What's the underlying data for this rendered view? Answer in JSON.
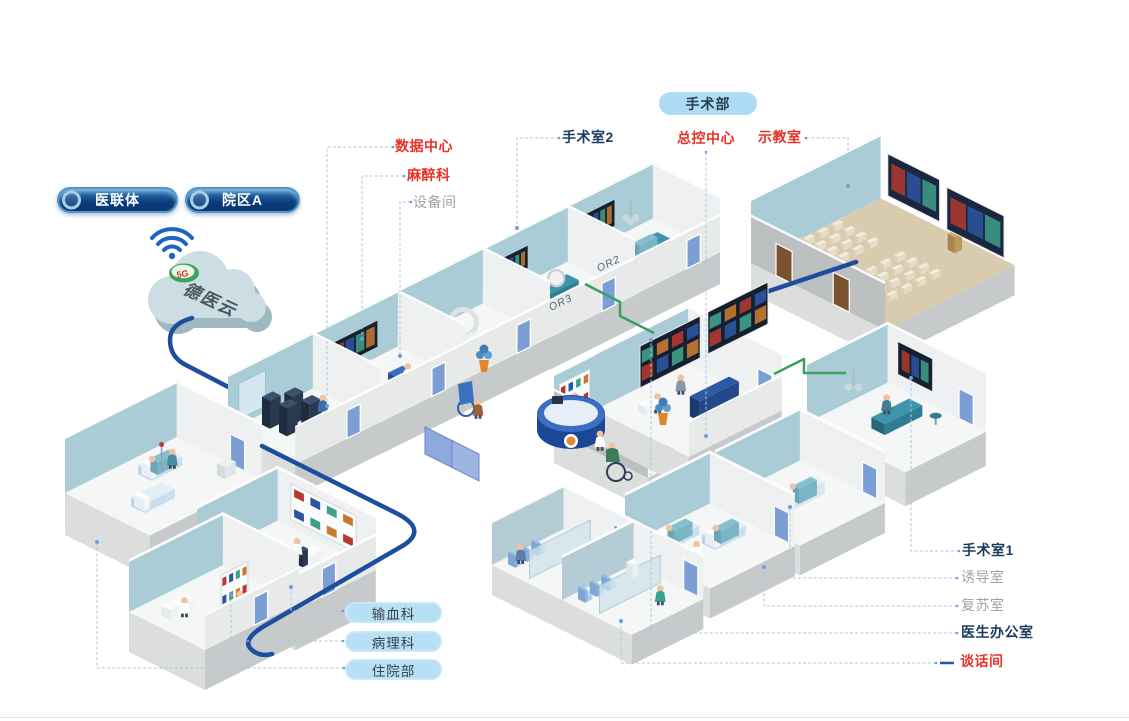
{
  "buttons": {
    "consortium": "医联体",
    "campus": "院区A"
  },
  "cloud": {
    "name": "德医云",
    "badge": "5G"
  },
  "tags": {
    "surgery_dept": "手术部",
    "blood_transfusion": "输血科",
    "pathology": "病理科",
    "inpatient": "住院部"
  },
  "labels": {
    "data_center": "数据中心",
    "anesthesiology": "麻醉科",
    "equipment_room": "设备间",
    "operating_room_2": "手术室2",
    "master_control": "总控中心",
    "demo_classroom": "示教室",
    "operating_room_1": "手术室1",
    "induction_room": "诱导室",
    "recovery_room": "复苏室",
    "doctor_office": "医生办公室",
    "talk_room": "谈话间"
  },
  "wall_text": {
    "or2_door": "OR2",
    "or3_door": "OR3"
  },
  "colors": {
    "label_red": "#e6332a",
    "label_navy": "#1b3c5e",
    "label_gray": "#9fa4a8",
    "pill_light_bg": "#b8e0f5",
    "dept_pill_bg": "#aedcf5",
    "pill_dark_bg": "#0b3c7d",
    "backbone_blue": "#1d4e9e",
    "link_green": "#3c9e63",
    "leader_blue": "#a9c6e4",
    "wall_teal": "#a9ccd7",
    "floor_tan": "#d9cbae",
    "cloud_body": "#ccdde4",
    "wifi_blue": "#1a66c0",
    "badge_green": "#3da35b"
  }
}
